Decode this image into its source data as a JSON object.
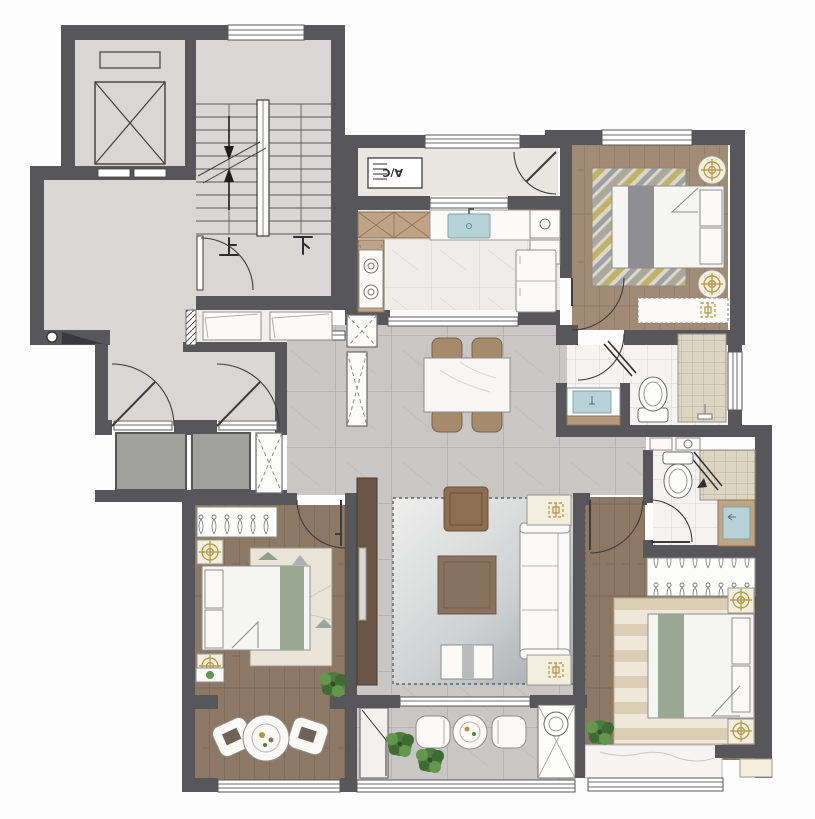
{
  "title": "apartment-floor-plan",
  "labels": {
    "stair_up": "上",
    "stair_down": "下",
    "ac_unit": "A/C"
  },
  "rooms": [
    "elevator-shaft",
    "stairwell",
    "lobby",
    "entry-hall",
    "service-balcony",
    "kitchen",
    "bedroom-top-right",
    "bathroom-1",
    "bathroom-2",
    "dining-room",
    "living-room",
    "bedroom-bottom-left",
    "sitting-area",
    "balcony",
    "master-bedroom"
  ],
  "colors": {
    "wall": "#57575b",
    "floor_concrete": "#d9d7d3",
    "floor_tile": "#c8c7c5",
    "tile_line": "#a9a8a5",
    "floor_kitchen": "#efede9",
    "floor_bath": "#f4f3f1",
    "shower_tile": "#ddd5c1",
    "wood_light": "#a18a76",
    "wood_dark": "#8d7866",
    "accent_gold": "#b3953f",
    "sink_teal": "#b7d2d6",
    "plant_green": "#527f40",
    "furniture_wood": "#6b5544",
    "duvet": "#f5f5f3",
    "runner_gray": "#8f8f93",
    "runner_sage": "#9aa893"
  }
}
